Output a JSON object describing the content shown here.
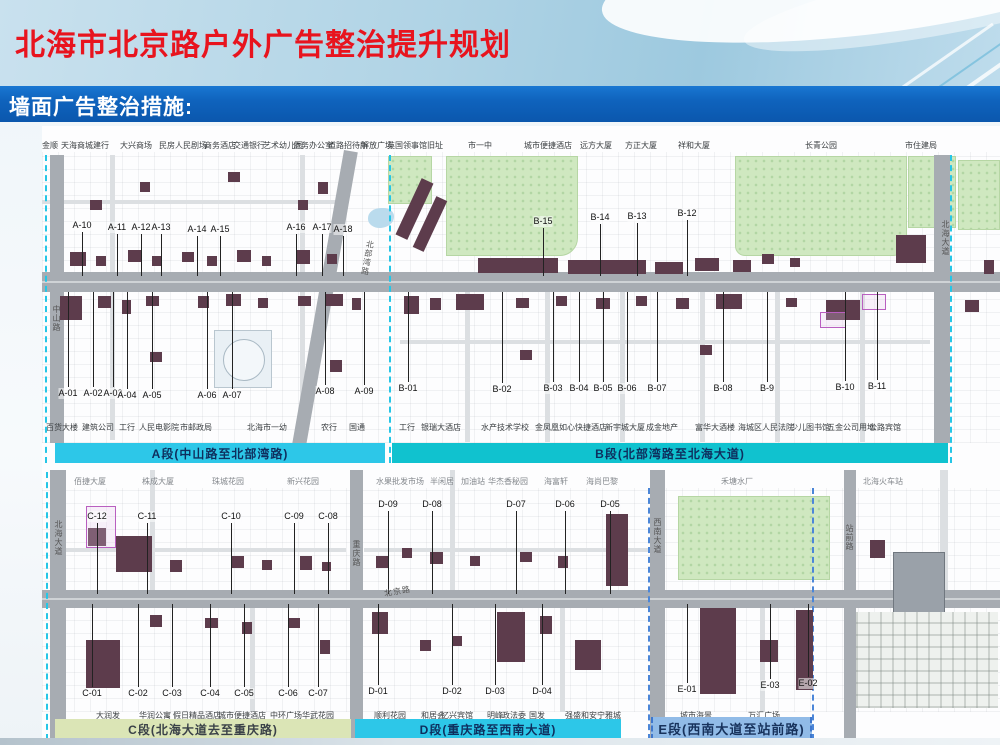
{
  "header": {
    "title": "北海市北京路户外广告整治提升规划",
    "subtitle": "墙面广告整治措施:"
  },
  "banners": {
    "a": "A段(中山路至北部湾路)",
    "b": "B段(北部湾路至北海大道)",
    "c": "C段(北海大道去至重庆路)",
    "d": "D段(重庆路至西南大道)",
    "e": "E段(西南大道至站前路)"
  },
  "colors": {
    "title_red": "#e8141e",
    "banner_blue": "#0f63bd",
    "segment_cyan": "#2dc7e8",
    "segment_teal": "#10c2cf",
    "segment_olive": "#dbe5b6",
    "segment_lightblue": "#91bbe7",
    "building_maroon": "#5d3c4c",
    "park_green": "#cfe8c0",
    "road_gray": "#a7acb2"
  },
  "map_top": {
    "poi_top": {
      "y": 141,
      "items": [
        {
          "t": "金顺",
          "x": 50
        },
        {
          "t": "天海商城",
          "x": 77
        },
        {
          "t": "建行",
          "x": 101
        },
        {
          "t": "大兴商场",
          "x": 136
        },
        {
          "t": "民房",
          "x": 167
        },
        {
          "t": "人民剧场",
          "x": 191
        },
        {
          "t": "商务酒店",
          "x": 220
        },
        {
          "t": "交通银行",
          "x": 249
        },
        {
          "t": "艺术幼儿园",
          "x": 283
        },
        {
          "t": "侨务办公室",
          "x": 313
        },
        {
          "t": "道路招待所",
          "x": 348
        },
        {
          "t": "解放广场",
          "x": 377
        },
        {
          "t": "英国领事馆旧址",
          "x": 415
        },
        {
          "t": "市一中",
          "x": 480
        },
        {
          "t": "城市便捷酒店",
          "x": 548
        },
        {
          "t": "远方大厦",
          "x": 596
        },
        {
          "t": "方正大厦",
          "x": 641
        },
        {
          "t": "祥和大厦",
          "x": 694
        },
        {
          "t": "长青公园",
          "x": 821
        },
        {
          "t": "市住建局",
          "x": 921
        }
      ]
    },
    "poi_bottom": {
      "y": 423,
      "items": [
        {
          "t": "百货大楼",
          "x": 62
        },
        {
          "t": "建筑公司",
          "x": 98
        },
        {
          "t": "工行",
          "x": 127
        },
        {
          "t": "人民电影院",
          "x": 159
        },
        {
          "t": "市邮政局",
          "x": 196
        },
        {
          "t": "北海市一幼",
          "x": 267
        },
        {
          "t": "农行",
          "x": 329
        },
        {
          "t": "国通",
          "x": 357
        },
        {
          "t": "工行",
          "x": 407
        },
        {
          "t": "银瑞大酒店",
          "x": 441
        },
        {
          "t": "水产技术学校",
          "x": 505
        },
        {
          "t": "金凤凰",
          "x": 547
        },
        {
          "t": "如心快捷酒店",
          "x": 583
        },
        {
          "t": "新宇城大厦",
          "x": 625
        },
        {
          "t": "成金地产",
          "x": 662
        },
        {
          "t": "富华大酒楼",
          "x": 715
        },
        {
          "t": "海城区人民法院",
          "x": 766
        },
        {
          "t": "少儿图书馆",
          "x": 810
        },
        {
          "t": "五金公司用地",
          "x": 851
        },
        {
          "t": "公路宾馆",
          "x": 885
        }
      ]
    },
    "road_labels": [
      {
        "t": "中山路",
        "x": 51,
        "y": 305,
        "mode": "v"
      },
      {
        "t": "北部湾路",
        "x": 362,
        "y": 240,
        "mode": "v",
        "rot": 10
      },
      {
        "t": "北海大道",
        "x": 940,
        "y": 220,
        "mode": "v"
      }
    ],
    "markers": [
      {
        "t": "A-10",
        "x": 82,
        "y": 226,
        "dir": "down"
      },
      {
        "t": "A-11",
        "x": 117,
        "y": 228,
        "dir": "down"
      },
      {
        "t": "A-12",
        "x": 141,
        "y": 228,
        "dir": "down"
      },
      {
        "t": "A-13",
        "x": 161,
        "y": 228,
        "dir": "down"
      },
      {
        "t": "A-14",
        "x": 197,
        "y": 230,
        "dir": "down"
      },
      {
        "t": "A-15",
        "x": 220,
        "y": 230,
        "dir": "down"
      },
      {
        "t": "A-16",
        "x": 296,
        "y": 228,
        "dir": "down"
      },
      {
        "t": "A-17",
        "x": 322,
        "y": 228,
        "dir": "down"
      },
      {
        "t": "A-18",
        "x": 343,
        "y": 230,
        "dir": "down"
      },
      {
        "t": "A-01",
        "x": 68,
        "y": 394,
        "dir": "up"
      },
      {
        "t": "A-02",
        "x": 93,
        "y": 394,
        "dir": "up"
      },
      {
        "t": "A-03",
        "x": 113,
        "y": 394,
        "dir": "up"
      },
      {
        "t": "A-04",
        "x": 127,
        "y": 396,
        "dir": "up"
      },
      {
        "t": "A-05",
        "x": 152,
        "y": 396,
        "dir": "up"
      },
      {
        "t": "A-06",
        "x": 207,
        "y": 396,
        "dir": "up"
      },
      {
        "t": "A-07",
        "x": 232,
        "y": 396,
        "dir": "up"
      },
      {
        "t": "A-08",
        "x": 325,
        "y": 392,
        "dir": "up"
      },
      {
        "t": "A-09",
        "x": 364,
        "y": 392,
        "dir": "up"
      },
      {
        "t": "B-15",
        "x": 543,
        "y": 222,
        "dir": "down"
      },
      {
        "t": "B-14",
        "x": 600,
        "y": 218,
        "dir": "down"
      },
      {
        "t": "B-13",
        "x": 637,
        "y": 217,
        "dir": "down"
      },
      {
        "t": "B-12",
        "x": 687,
        "y": 214,
        "dir": "down"
      },
      {
        "t": "B-01",
        "x": 408,
        "y": 389,
        "dir": "up"
      },
      {
        "t": "B-02",
        "x": 502,
        "y": 390,
        "dir": "up"
      },
      {
        "t": "B-03",
        "x": 553,
        "y": 389,
        "dir": "up"
      },
      {
        "t": "B-04",
        "x": 579,
        "y": 389,
        "dir": "up"
      },
      {
        "t": "B-05",
        "x": 603,
        "y": 389,
        "dir": "up"
      },
      {
        "t": "B-06",
        "x": 627,
        "y": 389,
        "dir": "up"
      },
      {
        "t": "B-07",
        "x": 657,
        "y": 389,
        "dir": "up"
      },
      {
        "t": "B-08",
        "x": 723,
        "y": 389,
        "dir": "up"
      },
      {
        "t": "B-9",
        "x": 767,
        "y": 389,
        "dir": "up"
      },
      {
        "t": "B-10",
        "x": 845,
        "y": 388,
        "dir": "up"
      },
      {
        "t": "B-11",
        "x": 877,
        "y": 387,
        "dir": "up"
      }
    ]
  },
  "map_bottom": {
    "poi_top": {
      "y": 477,
      "items": [
        {
          "t": "佰捷大厦",
          "x": 90
        },
        {
          "t": "株成大厦",
          "x": 158
        },
        {
          "t": "珠城花园",
          "x": 228
        },
        {
          "t": "新兴花园",
          "x": 303
        },
        {
          "t": "水果批发市场",
          "x": 400
        },
        {
          "t": "半闲居",
          "x": 442
        },
        {
          "t": "加油站",
          "x": 473
        },
        {
          "t": "华杰香秘园",
          "x": 508
        },
        {
          "t": "海富轩",
          "x": 556
        },
        {
          "t": "海尚巴黎",
          "x": 602
        },
        {
          "t": "禾塘水厂",
          "x": 737
        },
        {
          "t": "北海火车站",
          "x": 883
        }
      ]
    },
    "poi_bottom": {
      "y": 711,
      "items": [
        {
          "t": "大润发",
          "x": 108
        },
        {
          "t": "华润公寓",
          "x": 155
        },
        {
          "t": "假日精品酒店",
          "x": 197
        },
        {
          "t": "城市便捷酒店",
          "x": 242
        },
        {
          "t": "中环广场",
          "x": 286
        },
        {
          "t": "华武花园",
          "x": 318
        },
        {
          "t": "顺利花园",
          "x": 390
        },
        {
          "t": "和居会",
          "x": 433
        },
        {
          "t": "忆兴宾馆",
          "x": 457
        },
        {
          "t": "明峰",
          "x": 495
        },
        {
          "t": "政法委",
          "x": 514
        },
        {
          "t": "国发",
          "x": 537
        },
        {
          "t": "强盛和安宁雅城",
          "x": 593
        },
        {
          "t": "城市海景",
          "x": 696
        },
        {
          "t": "万汇广场",
          "x": 764
        }
      ]
    },
    "road_labels": [
      {
        "t": "北海大道",
        "x": 53,
        "y": 520,
        "mode": "v"
      },
      {
        "t": "重庆路",
        "x": 351,
        "y": 540,
        "mode": "v"
      },
      {
        "t": "北京路",
        "x": 384,
        "y": 586,
        "mode": "h",
        "rot": -10
      },
      {
        "t": "西南大道",
        "x": 652,
        "y": 518,
        "mode": "v"
      },
      {
        "t": "站前路",
        "x": 844,
        "y": 524,
        "mode": "v"
      }
    ],
    "markers": [
      {
        "t": "C-12",
        "x": 97,
        "y": 517,
        "dir": "down"
      },
      {
        "t": "C-11",
        "x": 147,
        "y": 517,
        "dir": "down"
      },
      {
        "t": "C-10",
        "x": 231,
        "y": 517,
        "dir": "down"
      },
      {
        "t": "C-09",
        "x": 294,
        "y": 517,
        "dir": "down"
      },
      {
        "t": "C-08",
        "x": 328,
        "y": 517,
        "dir": "down"
      },
      {
        "t": "C-01",
        "x": 92,
        "y": 694,
        "dir": "up"
      },
      {
        "t": "C-02",
        "x": 138,
        "y": 694,
        "dir": "up"
      },
      {
        "t": "C-03",
        "x": 172,
        "y": 694,
        "dir": "up"
      },
      {
        "t": "C-04",
        "x": 210,
        "y": 694,
        "dir": "up"
      },
      {
        "t": "C-05",
        "x": 244,
        "y": 694,
        "dir": "up"
      },
      {
        "t": "C-06",
        "x": 288,
        "y": 694,
        "dir": "up"
      },
      {
        "t": "C-07",
        "x": 318,
        "y": 694,
        "dir": "up"
      },
      {
        "t": "D-09",
        "x": 388,
        "y": 505,
        "dir": "down"
      },
      {
        "t": "D-08",
        "x": 432,
        "y": 505,
        "dir": "down"
      },
      {
        "t": "D-07",
        "x": 516,
        "y": 505,
        "dir": "down"
      },
      {
        "t": "D-06",
        "x": 565,
        "y": 505,
        "dir": "down"
      },
      {
        "t": "D-05",
        "x": 610,
        "y": 505,
        "dir": "down"
      },
      {
        "t": "D-01",
        "x": 378,
        "y": 692,
        "dir": "up"
      },
      {
        "t": "D-02",
        "x": 452,
        "y": 692,
        "dir": "up"
      },
      {
        "t": "D-03",
        "x": 495,
        "y": 692,
        "dir": "up"
      },
      {
        "t": "D-04",
        "x": 542,
        "y": 692,
        "dir": "up"
      },
      {
        "t": "E-01",
        "x": 687,
        "y": 690,
        "dir": "up"
      },
      {
        "t": "E-03",
        "x": 770,
        "y": 686,
        "dir": "up"
      },
      {
        "t": "E-02",
        "x": 808,
        "y": 684,
        "dir": "up"
      }
    ]
  }
}
